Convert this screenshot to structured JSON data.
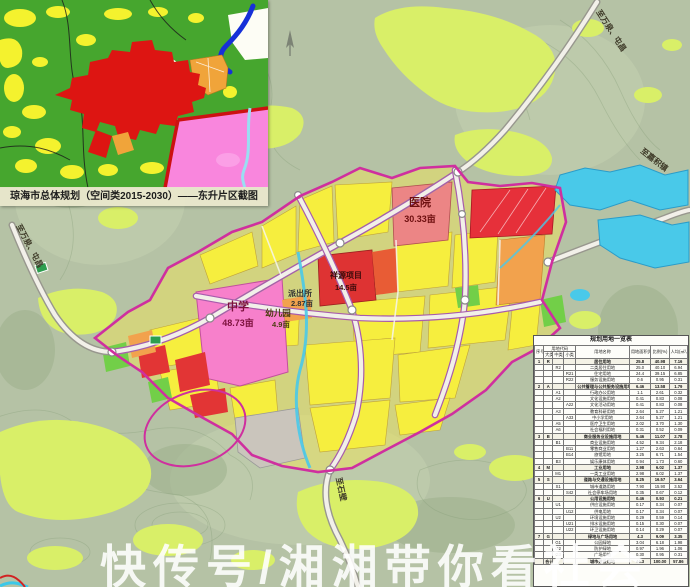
{
  "inset": {
    "caption": "琼海市总体规划（空间类2015-2030）——东升片区截图"
  },
  "labels": {
    "hospital": "医院",
    "hospital_area": "30.33亩",
    "school": "中学",
    "school_area": "48.73亩",
    "kindergarten": "幼儿园",
    "kindergarten_area": "4.9亩",
    "police": "派出所",
    "police_area": "2.87亩",
    "project": "祥源项目",
    "project_area": "14.5亩"
  },
  "road_labels": {
    "to_wanquan_tunchang_ne": "至万泉、屯昌",
    "to_wanquan_tunchang_w": "至万泉、屯昌",
    "to_jiaji": "至嘉积镇",
    "to_south": "至石壁"
  },
  "watermark": "快传号/湘湘带你看社会",
  "table": {
    "title": "规划用地一览表",
    "col_headers": {
      "seq": "序号",
      "code": "用地代码",
      "big": "大类",
      "mid": "中类",
      "small": "小类",
      "name": "用地名称",
      "area": "用地面积(ha)",
      "pct": "比例(%)",
      "percap": "人均(㎡/人)"
    },
    "rows": [
      [
        "1",
        "R",
        "",
        "",
        "居住用地",
        "25.8",
        "40.98",
        "7.16"
      ],
      [
        "",
        "",
        "R2",
        "",
        "二类居住用地",
        "25.0",
        "40.10",
        "6.94"
      ],
      [
        "",
        "",
        "",
        "R21",
        "住宅用地",
        "24.4",
        "39.15",
        "6.85"
      ],
      [
        "",
        "",
        "",
        "R22",
        "服务设施用地",
        "0.6",
        "0.95",
        "0.31"
      ],
      [
        "2",
        "A",
        "",
        "",
        "公共管理与公共服务设施用地",
        "6.46",
        "13.58",
        "1.79"
      ],
      [
        "",
        "",
        "A1",
        "",
        "行政办公用地",
        "1.1",
        "2.61",
        "0.32"
      ],
      [
        "",
        "",
        "A2",
        "",
        "文化设施用地",
        "0.41",
        "0.83",
        "0.08"
      ],
      [
        "",
        "",
        "",
        "A22",
        "文化活动用地",
        "0.41",
        "0.83",
        "0.08"
      ],
      [
        "",
        "",
        "A3",
        "",
        "教育科研用地",
        "2.64",
        "5.27",
        "1.21"
      ],
      [
        "",
        "",
        "",
        "A33",
        "中小学用地",
        "2.64",
        "5.27",
        "1.21"
      ],
      [
        "",
        "",
        "A5",
        "",
        "医疗卫生用地",
        "2.02",
        "3.70",
        "1.30"
      ],
      [
        "",
        "",
        "A6",
        "",
        "社会福利用地",
        "0.31",
        "0.52",
        "0.09"
      ],
      [
        "3",
        "B",
        "",
        "",
        "商业服务业设施用地",
        "5.46",
        "11.07",
        "2.78"
      ],
      [
        "",
        "",
        "B1",
        "",
        "商业设施用地",
        "4.52",
        "9.34",
        "2.18"
      ],
      [
        "",
        "",
        "",
        "B11",
        "零售商业用地",
        "1.27",
        "2.63",
        "0.64"
      ],
      [
        "",
        "",
        "",
        "B14",
        "旅馆用地",
        "3.25",
        "6.71",
        "1.54"
      ],
      [
        "",
        "",
        "B3",
        "",
        "娱乐康体用地",
        "0.94",
        "1.73",
        "0.60"
      ],
      [
        "4",
        "M",
        "",
        "",
        "工业用地",
        "2.98",
        "6.02",
        "1.37"
      ],
      [
        "",
        "",
        "M1",
        "",
        "一类工业用地",
        "2.98",
        "6.02",
        "1.37"
      ],
      [
        "5",
        "S",
        "",
        "",
        "道路与交通设施用地",
        "8.25",
        "16.57",
        "3.64"
      ],
      [
        "",
        "",
        "S1",
        "",
        "城市道路用地",
        "7.90",
        "15.90",
        "3.52"
      ],
      [
        "",
        "",
        "",
        "S42",
        "社会停车场用地",
        "0.35",
        "0.67",
        "0.12"
      ],
      [
        "6",
        "U",
        "",
        "",
        "公用设施用地",
        "0.46",
        "0.93",
        "0.21"
      ],
      [
        "",
        "",
        "U1",
        "",
        "供应设施用地",
        "0.17",
        "0.34",
        "0.07"
      ],
      [
        "",
        "",
        "",
        "U12",
        "供电用地",
        "0.17",
        "0.34",
        "0.07"
      ],
      [
        "",
        "",
        "U2",
        "",
        "环境设施用地",
        "0.29",
        "0.59",
        "0.14"
      ],
      [
        "",
        "",
        "",
        "U21",
        "排水设施用地",
        "0.15",
        "0.30",
        "0.07"
      ],
      [
        "",
        "",
        "",
        "U22",
        "环卫设施用地",
        "0.14",
        "0.29",
        "0.07"
      ],
      [
        "7",
        "G",
        "",
        "",
        "绿地与广场用地",
        "4.3",
        "9.09",
        "3.35"
      ],
      [
        "",
        "",
        "G1",
        "",
        "公园绿地",
        "3.04",
        "6.18",
        "1.98"
      ],
      [
        "",
        "",
        "G2",
        "",
        "防护绿地",
        "0.97",
        "1.96",
        "1.06"
      ],
      [
        "",
        "",
        "G3",
        "",
        "广场用地",
        "0.30",
        "0.95",
        "0.31"
      ],
      [
        "",
        "合计",
        "",
        "",
        "城市建设用地",
        "44.3",
        "100.00",
        "57.86"
      ]
    ]
  },
  "colors": {
    "terrain_base": "#b5c2a5",
    "vegetation": "#d9ef68",
    "parcel_yellow": "#f6ee3e",
    "school_pink": "#f780cb",
    "hospital_red": "#ec8585",
    "project_red": "#de3333",
    "bright_red": "#e6303a",
    "orange": "#f2a24d",
    "park_green": "#72cf48",
    "grey_parcel": "#cac5bc",
    "water_cyan": "#49c9e9",
    "boundary_magenta": "#cf2f9f",
    "inset_green": "#46a62e",
    "inset_red": "#dd1512",
    "inset_pink": "#f986dd",
    "river_blue": "#1630d8"
  }
}
